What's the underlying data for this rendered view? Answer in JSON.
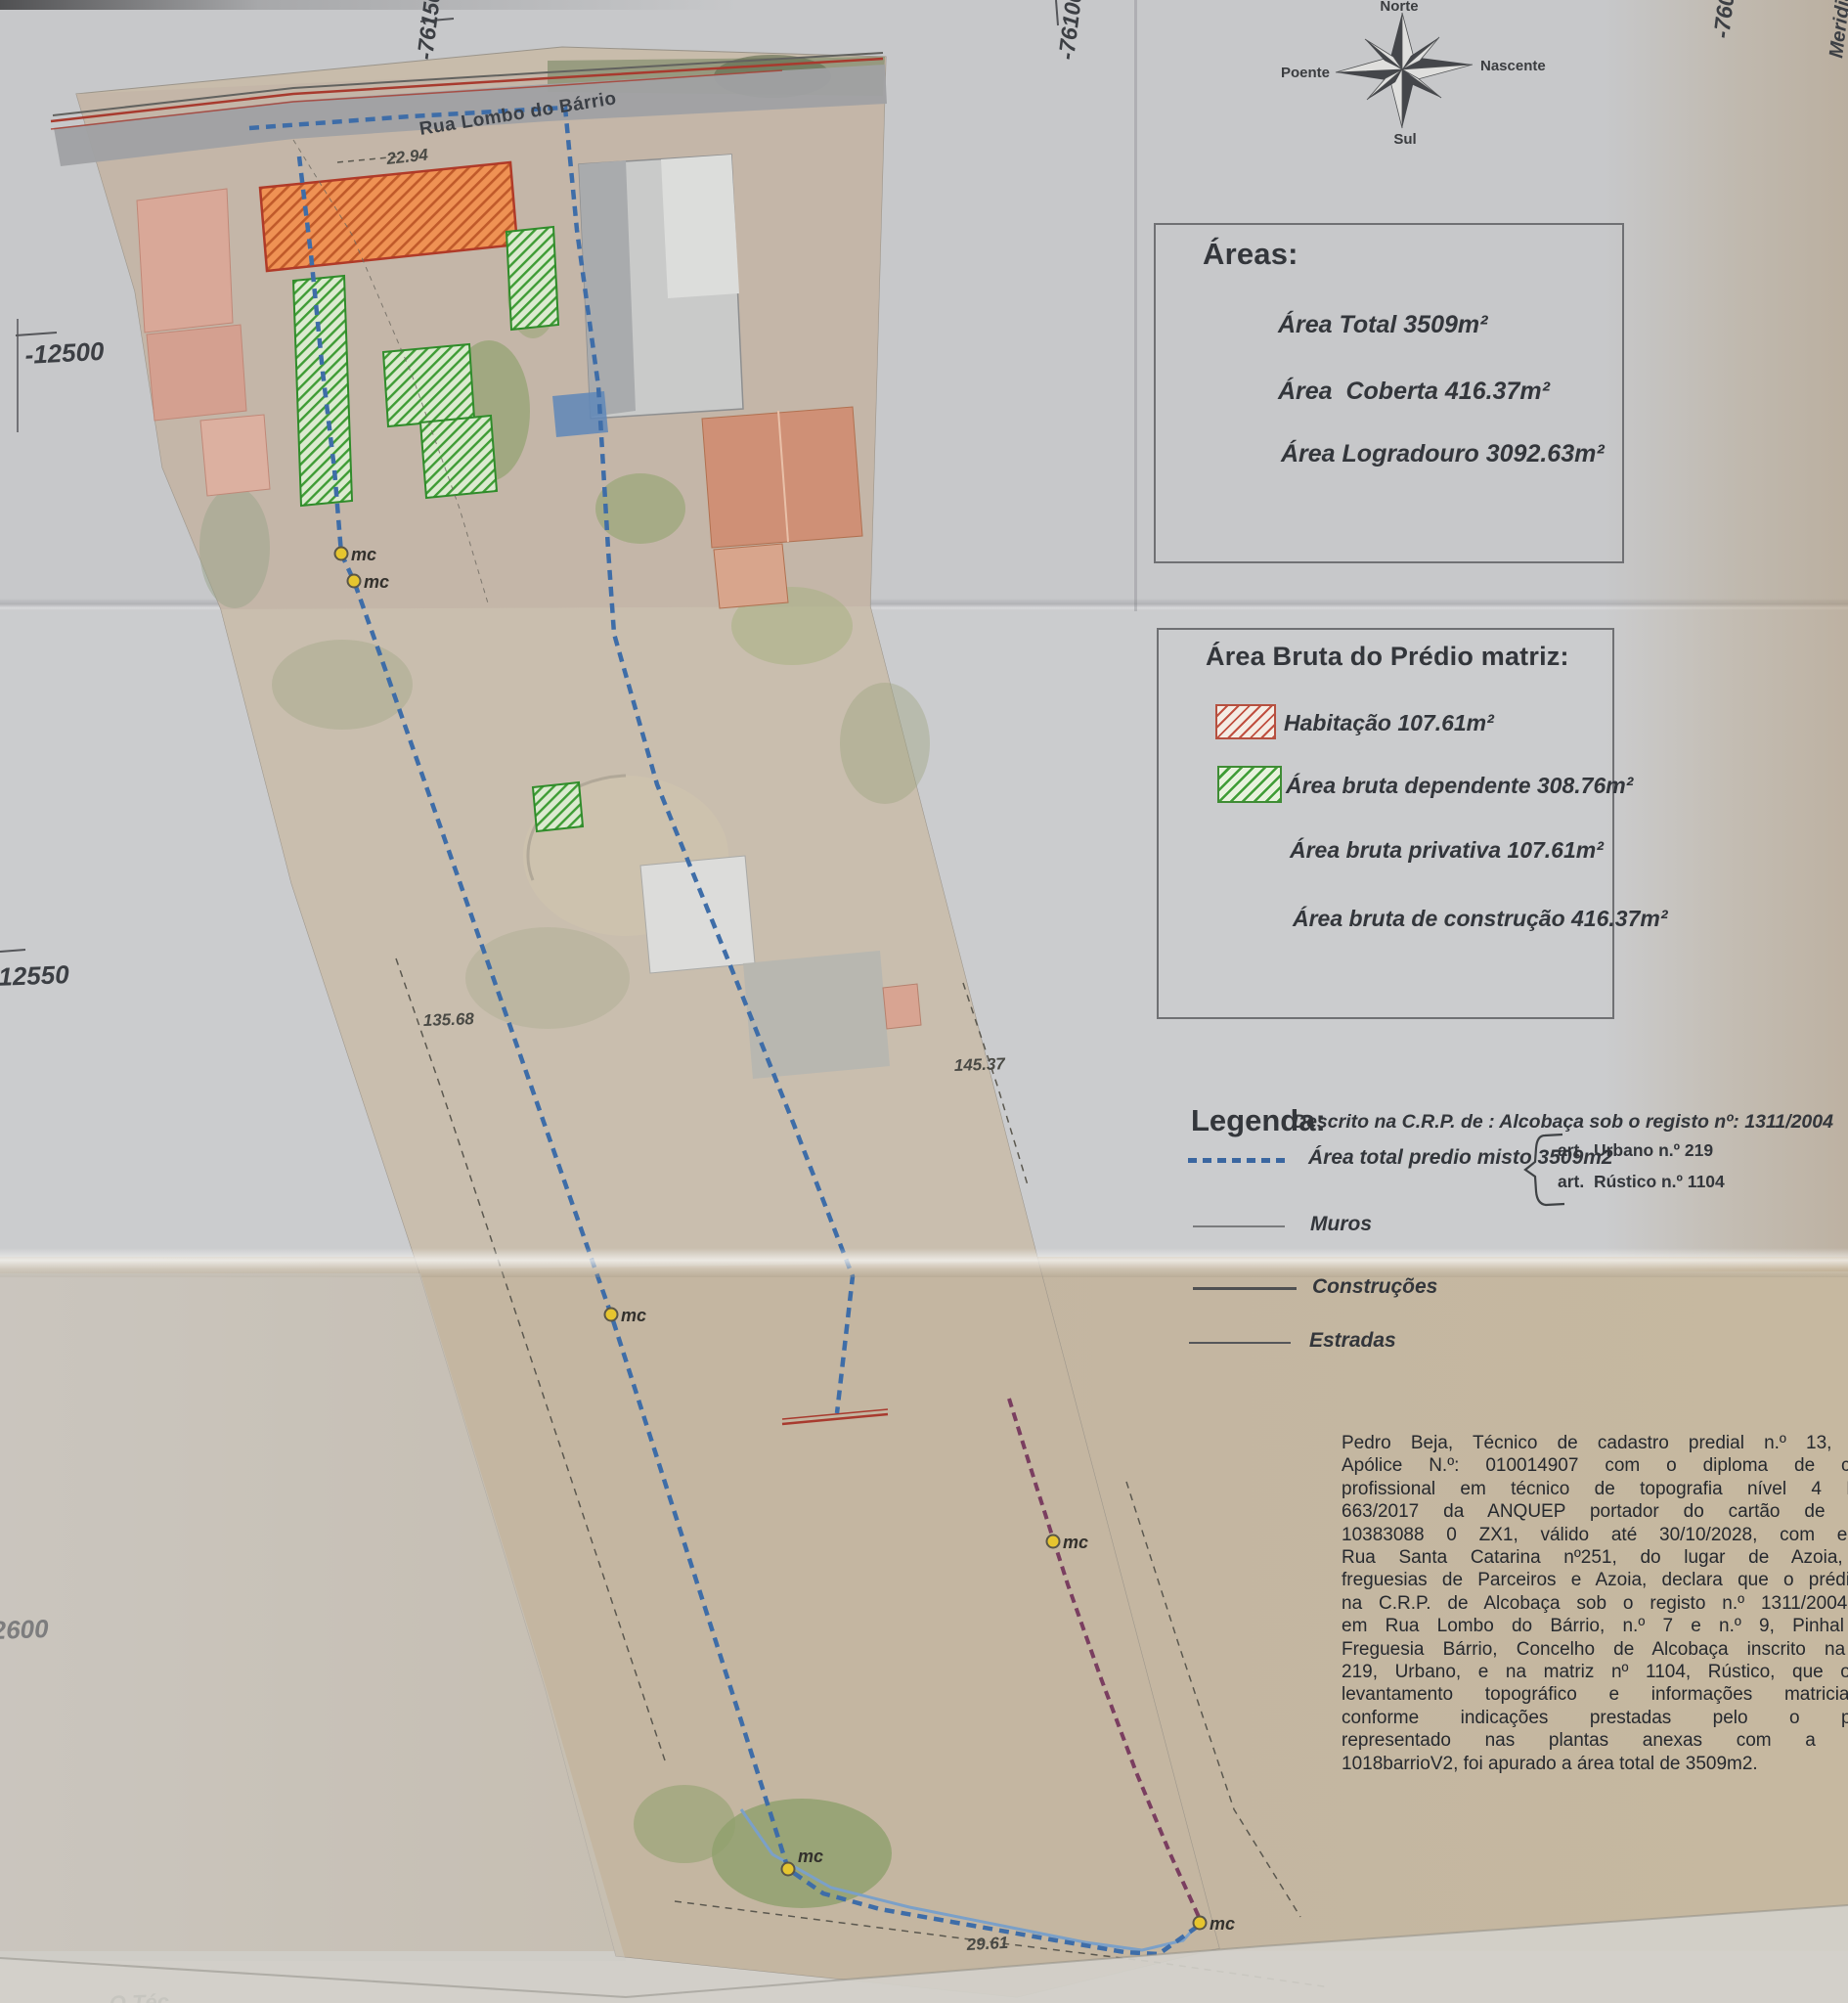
{
  "compass": {
    "north": "Norte",
    "south": "Sul",
    "east": "Nascente",
    "west": "Poente"
  },
  "grid": {
    "top_left": "-76150",
    "top_middle": "-76100",
    "top_right": "-760",
    "right_edge_partial": "Meridia",
    "left_upper": "-12500",
    "left_middle": "-12550",
    "left_lower": "2600",
    "bottom_left_partial": "O Téc"
  },
  "map": {
    "street_name": "Rua Lombo do Bárrio",
    "marker_label": "mc",
    "measurements": {
      "north_frontage": "22.94",
      "west_side": "135.68",
      "east_side": "145.37",
      "south_frontage": "29.61"
    }
  },
  "areas_box": {
    "title": "Áreas:",
    "total": "Área Total 3509m²",
    "coberta": "Área  Coberta 416.37m²",
    "logradouro": "Área Logradouro 3092.63m²"
  },
  "gross_area_box": {
    "title": "Área Bruta do Prédio matriz:",
    "habitacao": "Habitação 107.61m²",
    "dependente": "Área bruta dependente 308.76m²",
    "privativa": "Área bruta privativa 107.61m²",
    "construcao": "Área bruta de construção 416.37m²"
  },
  "legend": {
    "title": "Legenda:",
    "registry_note": "Descrito na C.R.P. de : Alcobaça sob o registo nº: 1311/2004",
    "total_line": "Área total predio misto 3509m2",
    "art_urbano": "art.  Urbano n.º 219",
    "art_rustico": "art.  Rústico n.º 1104",
    "muros": "Muros",
    "construcoes": "Construções",
    "estradas": "Estradas"
  },
  "declaration": {
    "lines": [
      "Pedro Beja, Técnico de cadastro predial n.º 13, topógra",
      "Apólice N.º: 010014907 com o diploma de certificaç",
      "profissional em técnico de topografia nível 4 Diploma",
      "663/2017 da ANQUEP portador do cartão de cidadão",
      "10383088 0 ZX1, válido até 30/10/2028, com endereço",
      "Rua Santa Catarina nº251, do lugar de Azoia, União",
      "freguesias de Parceiros e Azoia, declara que o prédio desc",
      "na C.R.P. de Alcobaça sob o registo n.º 1311/20040423 s",
      "em Rua Lombo do Bárrio, n.º 7 e n.º 9, Pinhal Fanhe",
      "Freguesia Bárrio, Concelho de Alcobaça inscrito na matriz",
      "219, Urbano, e na matriz nº 1104, Rústico,  que o prese",
      "levantamento topográfico e informações matriciais es",
      "conforme indicações prestadas pelo o proprietá",
      "representado nas plantas anexas com a designa",
      "1018barrioV2, foi apurado a área total de 3509m2."
    ]
  }
}
